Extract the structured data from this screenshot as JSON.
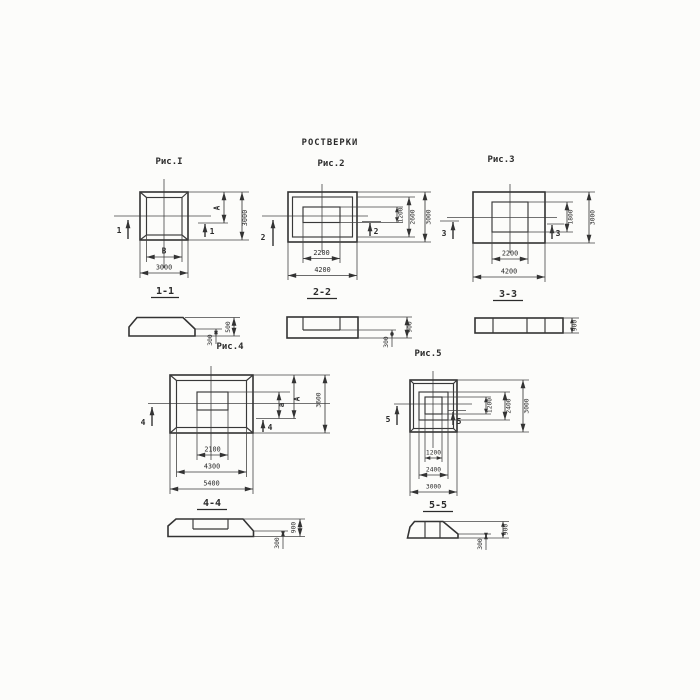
{
  "title": "РОСТВЕРКИ",
  "fig1": {
    "caption": "Рис.I",
    "cut_number": "1",
    "dim_inner_width": "B",
    "dim_outer_width": "3000",
    "dim_inner_height": "A",
    "dim_outer_height": "3000",
    "section_title": "1-1",
    "section_height_total": "500",
    "section_height_edge": "300"
  },
  "fig2": {
    "caption": "Рис.2",
    "cut_number": "2",
    "dim_inner_width": "2200",
    "dim_outer_width": "4200",
    "dim_h1": "1200",
    "dim_h2": "2600",
    "dim_h3": "3000",
    "section_title": "2-2",
    "section_height_total": "900",
    "section_height_edge": "300"
  },
  "fig3": {
    "caption": "Рис.3",
    "cut_number": "3",
    "dim_inner_width": "2200",
    "dim_outer_width": "4200",
    "dim_inner_height": "1800",
    "dim_outer_height": "3000",
    "section_title": "3-3",
    "section_height_total": "900"
  },
  "fig4": {
    "caption": "Рис.4",
    "cut_number": "4",
    "dim_w1": "2100",
    "dim_w2": "4300",
    "dim_w3": "5400",
    "dim_h1": "a",
    "dim_h2": "A",
    "dim_h3": "3600",
    "section_title": "4-4",
    "section_height_total": "900",
    "section_height_edge": "300"
  },
  "fig5": {
    "caption": "Рис.5",
    "cut_number": "5",
    "dim_w1": "1200",
    "dim_w2": "2400",
    "dim_w3": "3000",
    "dim_h1": "1200",
    "dim_h2": "2400",
    "dim_h3": "3000",
    "section_title": "5-5",
    "section_height_total": "900",
    "section_height_edge": "300"
  }
}
